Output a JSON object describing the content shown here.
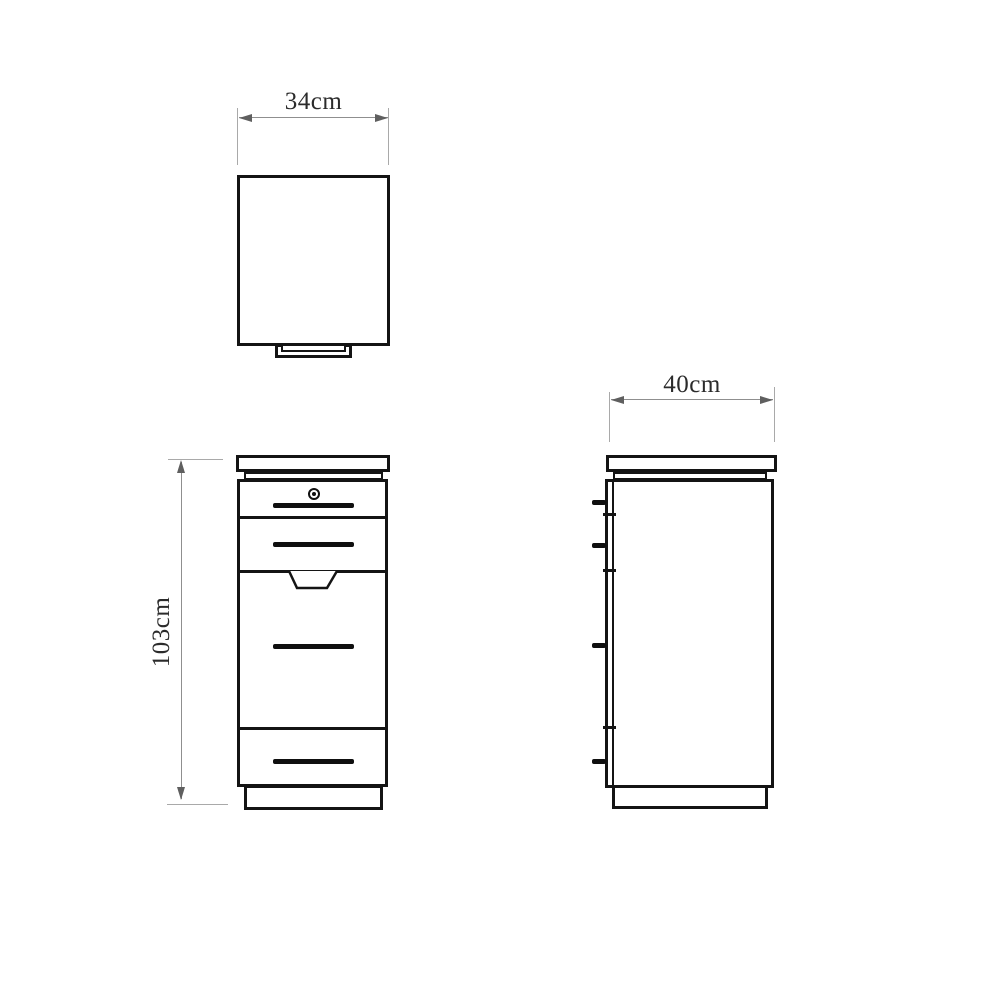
{
  "labels": {
    "top_view_width": "34cm",
    "side_view_depth": "40cm",
    "front_view_height": "103cm"
  },
  "colors": {
    "outline": "#141414",
    "dimension_line": "#8f8f8f",
    "extension_line": "#a9a9a9",
    "arrow": "#5f5f5f",
    "text": "#2b2b2b",
    "background": "#ffffff"
  }
}
